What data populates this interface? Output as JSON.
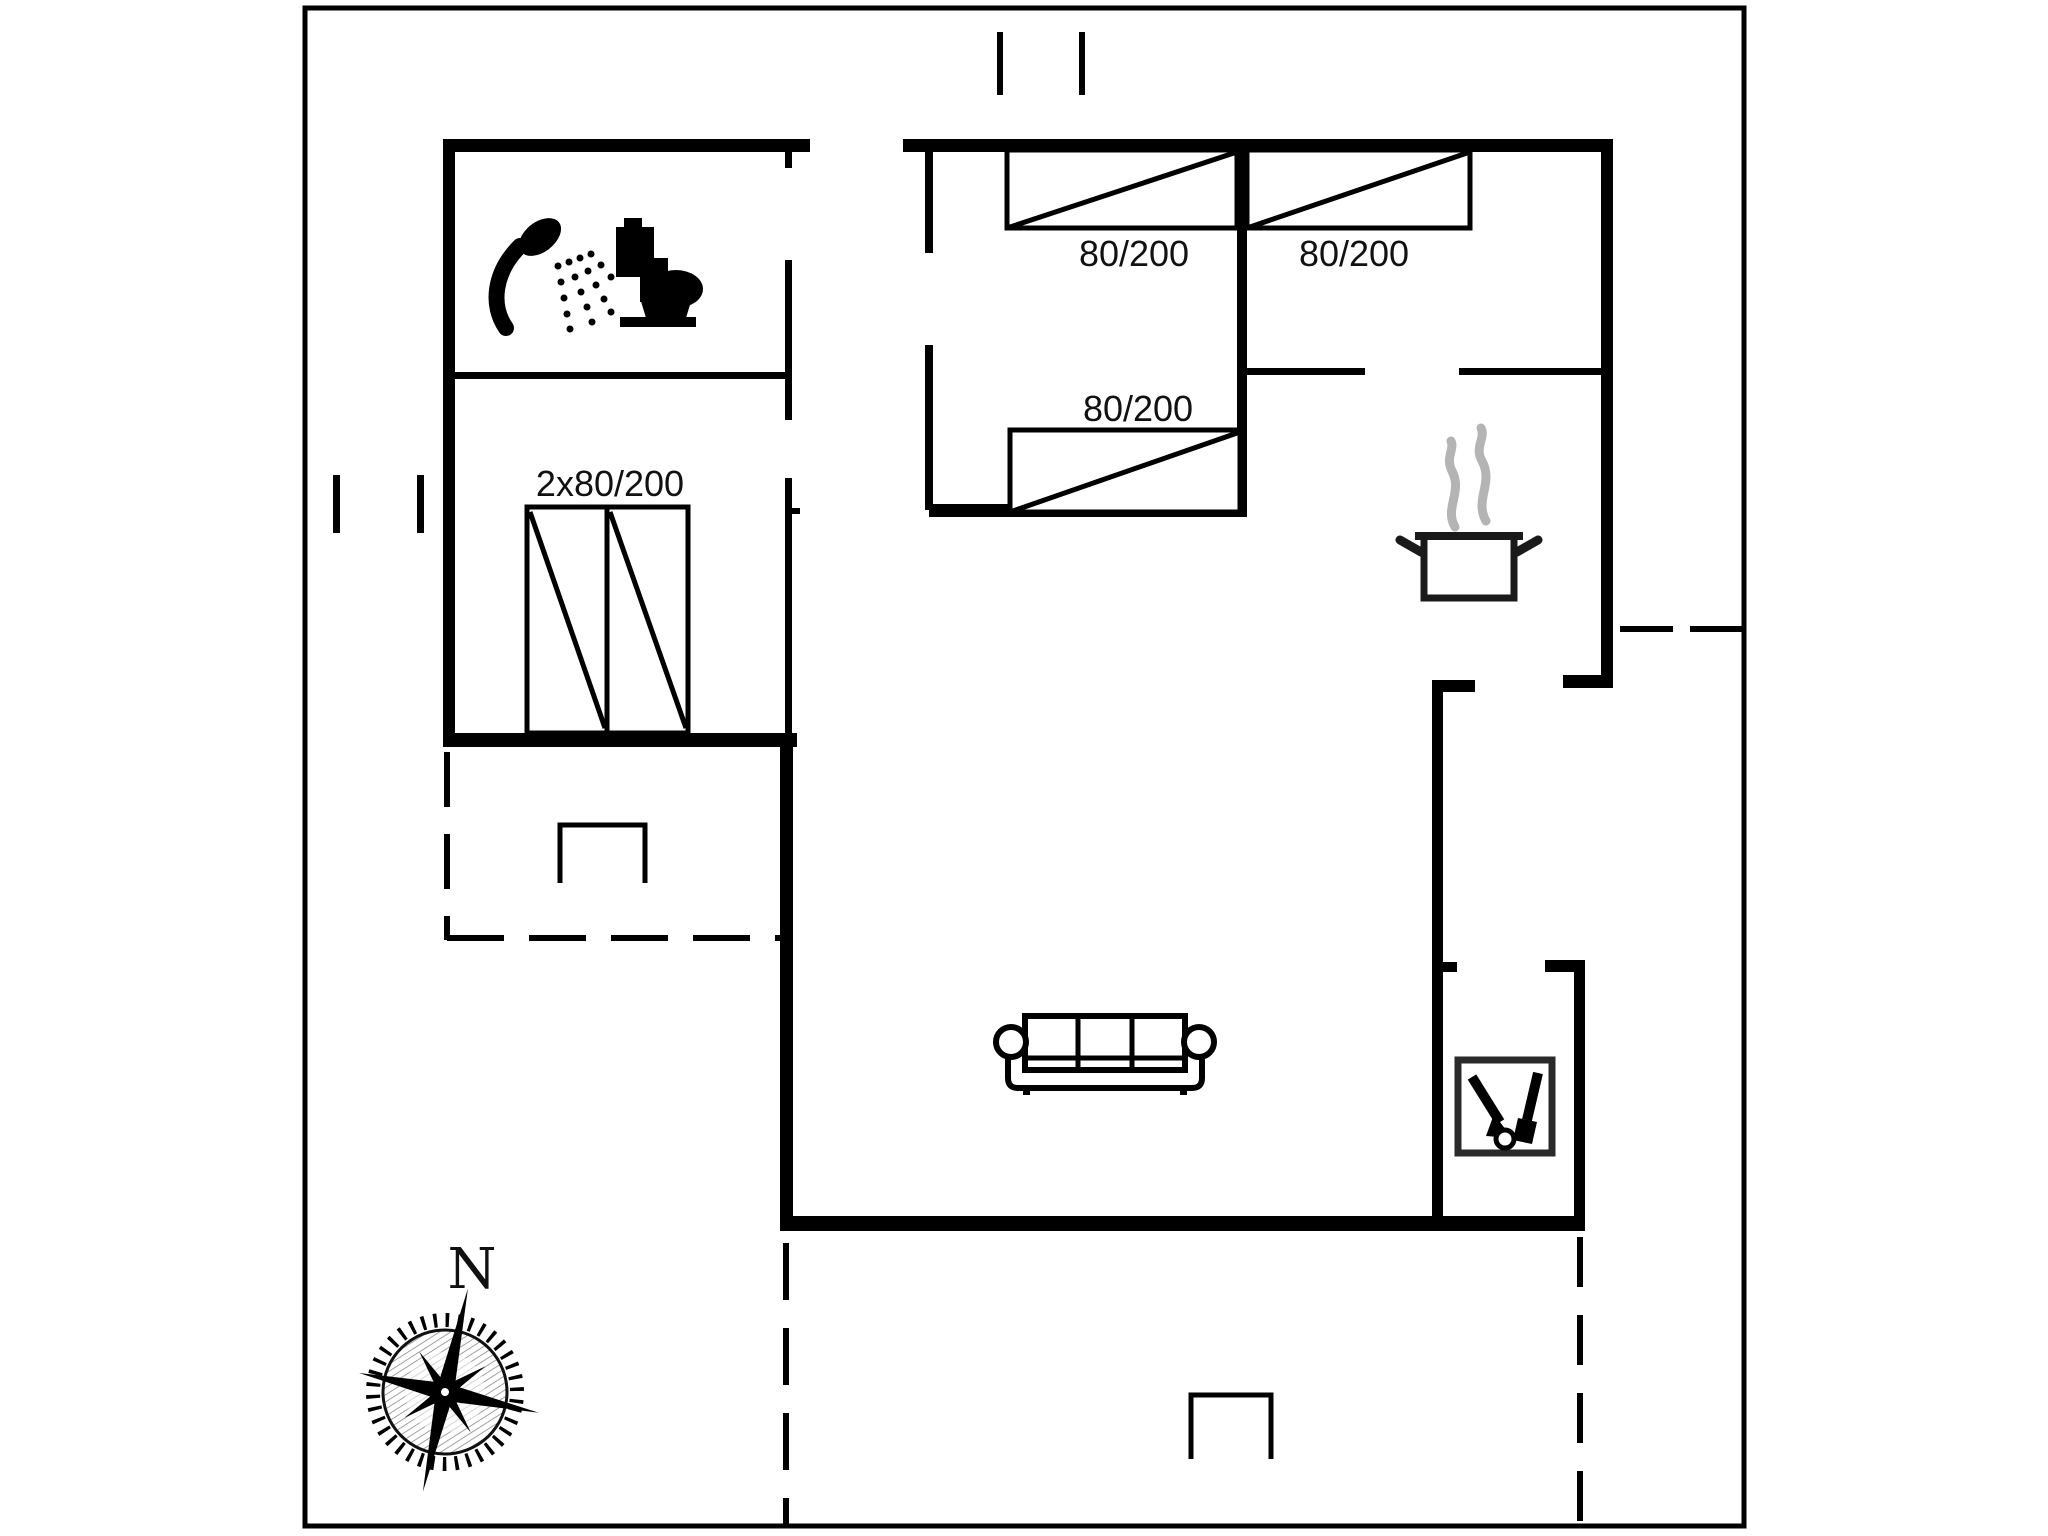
{
  "plan": {
    "type": "holiday-house floor plan",
    "compass": {
      "north_label": "N"
    },
    "bathroom": {
      "icons": [
        "shower-icon",
        "toilet-icon"
      ]
    },
    "bedroom_left": {
      "bed_size_label": "2x80/200"
    },
    "bedroom_middle": {
      "bed_top_label": "80/200",
      "bed_bottom_label": "80/200"
    },
    "bedroom_right": {
      "bed_label": "80/200"
    },
    "kitchen": {
      "icon": "cooking-pot-icon"
    },
    "living_room": {
      "icon": "sofa-icon"
    },
    "utility_room": {
      "icon": "wood-stove-icon"
    },
    "terrace": {
      "style": "dashed-outline"
    },
    "colors": {
      "walls": "#000000",
      "background": "#ffffff",
      "steam_gray": "#b4b4b4"
    }
  }
}
